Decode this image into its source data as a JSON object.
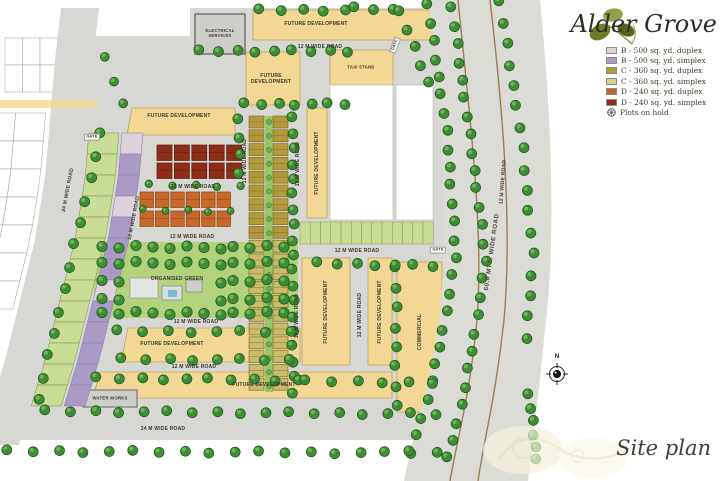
{
  "title": "Alder Grove",
  "subtitle": "Site plan",
  "compass": "N",
  "legend": {
    "items": [
      {
        "label": "B - 500 sq. yd. duplex",
        "color": "#ded0dd"
      },
      {
        "label": "B - 500 sq. yd. simplex",
        "color": "#a99bc6"
      },
      {
        "label": "C - 360 sq. yd. duplex",
        "color": "#b2993e"
      },
      {
        "label": "C - 360 sq. yd. simplex",
        "color": "#d8d28c"
      },
      {
        "label": "D - 240 sq. yd. duplex",
        "color": "#c2632a"
      },
      {
        "label": "D - 240 sq. yd. simplex",
        "color": "#8f2d18"
      },
      {
        "label": "Plots on hold"
      }
    ]
  },
  "labels": {
    "future_development": "FUTURE DEVELOPMENT",
    "commercial": "COMMERCIAL",
    "taxi_stand": "TAXI STAND",
    "electrical_services": "ELECTRICAL SERVICES",
    "water_works": "WATER WORKS",
    "organised_green": "ORGANISED GREEN",
    "gate": "GATE",
    "road_12m": "12 M WIDE ROAD",
    "road_24m": "24 M WIDE ROAD",
    "road_60m": "60.0 MTS. WIDE ROAD"
  },
  "colors": {
    "road": "#d7d7d3",
    "block_tan": "#f3d794",
    "block_border": "#bb8f3c",
    "gray_box": "#cdcdc9",
    "curve_road": "#dcdcd7",
    "median_brown": "#9c7d52",
    "park_green": "#b2d37c",
    "tree_green": "#3f8c36",
    "plot_green": "#c9dd95",
    "purple": "#a99bc6",
    "pink": "#ded0dd",
    "olive": "#b2993e",
    "olive_light": "#c9bc6d",
    "orange": "#c8682a",
    "maroon": "#8e2d18",
    "brand_olive": "#77862e"
  }
}
